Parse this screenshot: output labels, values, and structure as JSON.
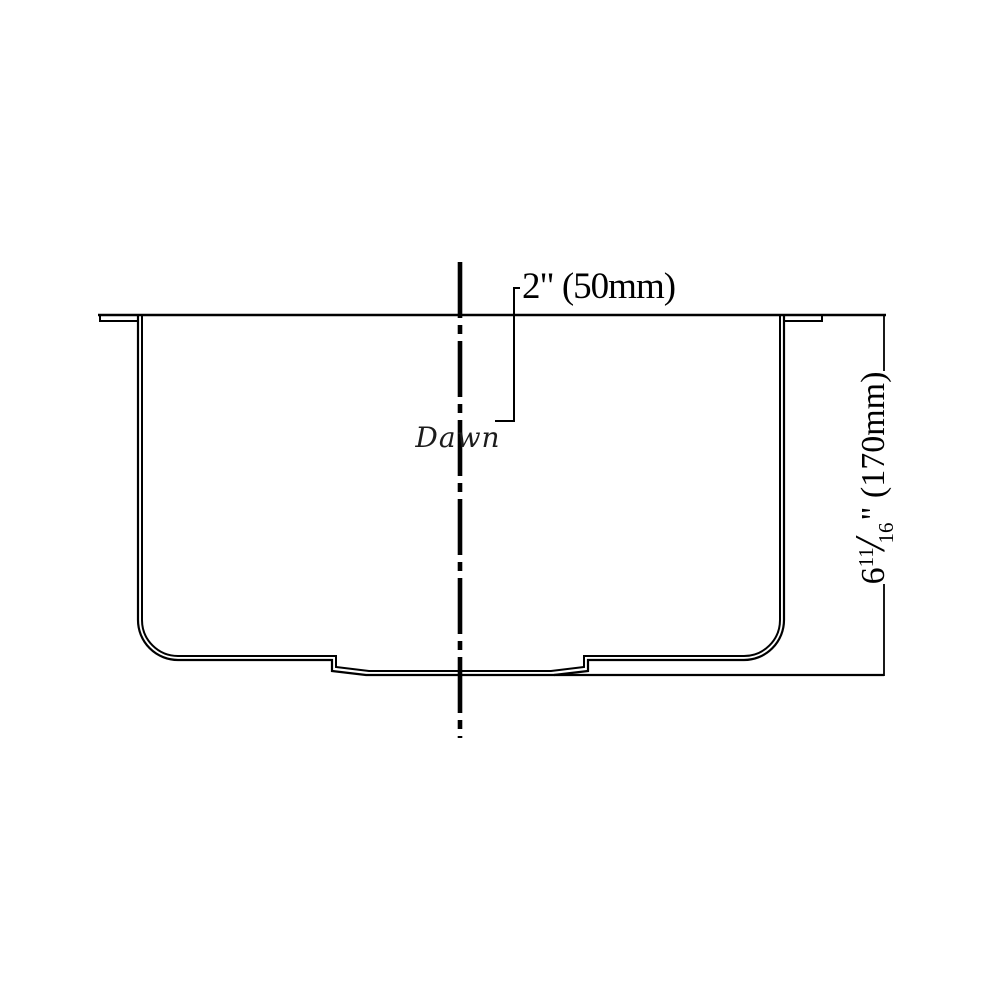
{
  "logo": {
    "text": "Dawn"
  },
  "top_dimension": {
    "label": "2\" (50mm)"
  },
  "side_dimension": {
    "whole": "6",
    "frac_numerator": "11",
    "frac_slash": "/",
    "frac_denominator": "16",
    "unit_mark": "\"",
    "metric": " (170mm)",
    "full_label": "6 11/16\" (170mm)"
  },
  "colors": {
    "line": "#000000",
    "background": "#ffffff",
    "logo": "#1c1c1c"
  }
}
